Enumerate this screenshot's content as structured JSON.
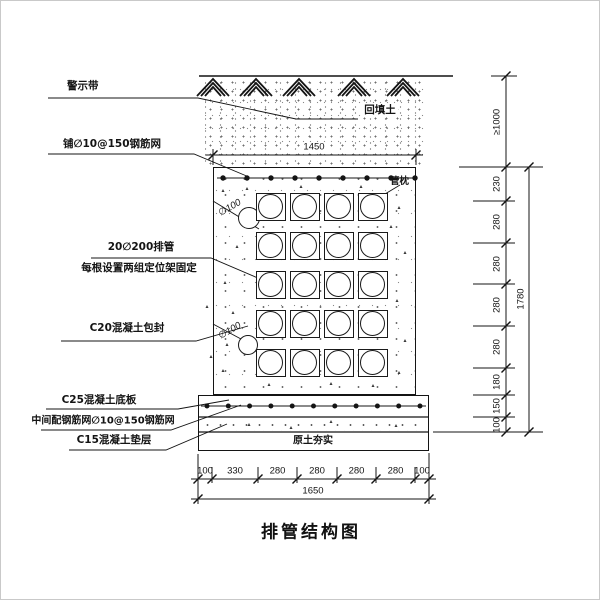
{
  "title": "排管结构图",
  "annotations": {
    "warning_tape": "警示带",
    "top_mesh": "铺∅10@150钢筋网",
    "pipe_bank_line1": "20∅200排管",
    "pipe_bank_line2": "每根设置两组定位架固定",
    "encasement": "C20混凝土包封",
    "base_slab": "C25混凝土底板",
    "slab_mesh": "中间配钢筋网∅10@150钢筋网",
    "cushion": "C15混凝土垫层",
    "backfill": "回填土",
    "pipe_support": "管枕",
    "compacted_soil": "原土夯实",
    "pipe_dia_upper": "∅100",
    "pipe_dia_lower": "∅100"
  },
  "dimensions": {
    "top_width": "1450",
    "right_chain": [
      "≥1000",
      "230",
      "280",
      "280",
      "280",
      "280",
      "180",
      "150",
      "100"
    ],
    "right_total": "1780",
    "bottom_chain": [
      "100",
      "330",
      "280",
      "280",
      "280",
      "280",
      "100"
    ],
    "bottom_total": "1650"
  },
  "pipe_grid": {
    "rows": 5,
    "columns": 4,
    "total_pipes": 20
  }
}
